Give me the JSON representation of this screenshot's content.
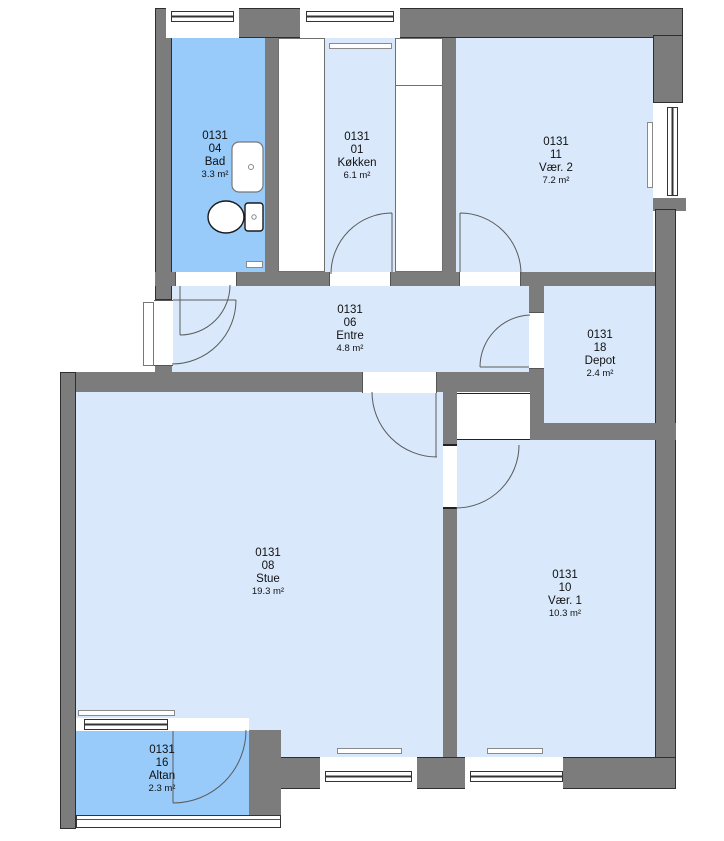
{
  "plan": {
    "type": "apartment-floor-plan",
    "building_unit": "0131",
    "colors": {
      "wall_gray": "#7c7c7c",
      "room_floor_blue": "#d9e9fb",
      "wet_room_blue": "#99cbfa",
      "outside_white": "#ffffff",
      "line_black": "#2f2f2f"
    }
  },
  "rooms": {
    "bad": {
      "id": "0131",
      "number": "04",
      "name": "Bad",
      "area": "3.3 m²"
    },
    "kokken": {
      "id": "0131",
      "number": "01",
      "name": "Køkken",
      "area": "6.1 m²"
    },
    "vaer2": {
      "id": "0131",
      "number": "11",
      "name": "Vær. 2",
      "area": "7.2 m²"
    },
    "entre": {
      "id": "0131",
      "number": "06",
      "name": "Entre",
      "area": "4.8 m²"
    },
    "depot": {
      "id": "0131",
      "number": "18",
      "name": "Depot",
      "area": "2.4 m²"
    },
    "stue": {
      "id": "0131",
      "number": "08",
      "name": "Stue",
      "area": "19.3 m²"
    },
    "vaer1": {
      "id": "0131",
      "number": "10",
      "name": "Vær. 1",
      "area": "10.3 m²"
    },
    "altan": {
      "id": "0131",
      "number": "16",
      "name": "Altan",
      "area": "2.3 m²"
    }
  }
}
